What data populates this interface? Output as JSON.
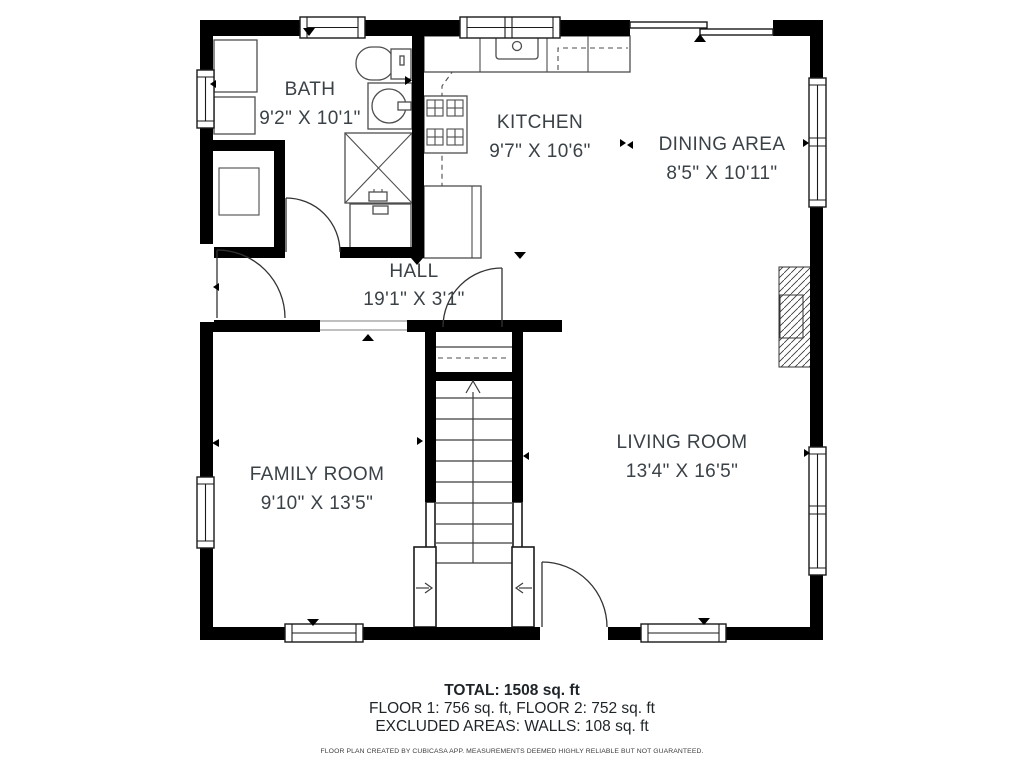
{
  "rooms": {
    "bath": {
      "name": "BATH",
      "dims": "9'2\" X 10'1\""
    },
    "kitchen": {
      "name": "KITCHEN",
      "dims": "9'7\" X 10'6\""
    },
    "dining": {
      "name": "DINING AREA",
      "dims": "8'5\" X 10'11\""
    },
    "hall": {
      "name": "HALL",
      "dims": "19'1\" X 3'1\""
    },
    "family": {
      "name": "FAMILY ROOM",
      "dims": "9'10\" X 13'5\""
    },
    "living": {
      "name": "LIVING ROOM",
      "dims": "13'4\" X 16'5\""
    }
  },
  "summary": {
    "total": "TOTAL: 1508 sq. ft",
    "floors": "FLOOR 1: 756 sq. ft, FLOOR 2: 752 sq. ft",
    "excluded": "EXCLUDED AREAS: WALLS: 108 sq. ft"
  },
  "disclaimer": "FLOOR PLAN CREATED BY CUBICASA APP. MEASUREMENTS DEEMED HIGHLY RELIABLE BUT NOT GUARANTEED.",
  "colors": {
    "wall": "#000000",
    "label": "#3b4247",
    "fixture": "#4d4d4d",
    "background": "#ffffff"
  }
}
